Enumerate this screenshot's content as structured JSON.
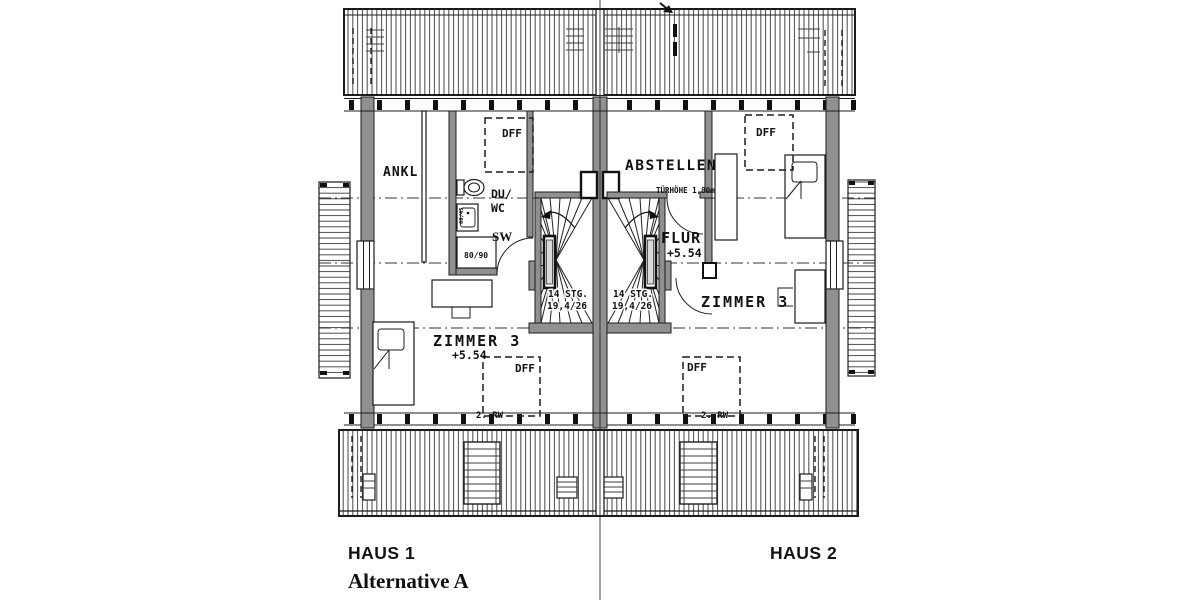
{
  "footer": {
    "haus1": "HAUS 1",
    "alternative": "Alternative A",
    "haus2": "HAUS 2"
  },
  "haus1": {
    "ankl": "ANKL",
    "dff_top": "DFF",
    "du": "DU/",
    "wc": "WC",
    "sw": "SW",
    "shower_size": "80/90",
    "basin_size": "60/45",
    "zimmer": "ZIMMER 3",
    "level": "+5.54",
    "dff_bottom": "DFF",
    "rw": "2. RW",
    "stairs_line1": "14 STG.",
    "stairs_line2": "19,4/26"
  },
  "haus2": {
    "abstellen": "ABSTELLEN",
    "door_height": "TÜRHÖHE 1,80m",
    "flur": "FLUR",
    "level": "+5.54",
    "dff_top": "DFF",
    "zimmer": "ZIMMER 3",
    "dff_bottom": "DFF",
    "rw": "2. RW",
    "stairs_line1": "14 STG.",
    "stairs_line2": "19,4/26"
  },
  "colors": {
    "wall_fill": "#909090",
    "line": "#1c1c1c",
    "hatch": "#4a4a4a",
    "background": "#ffffff"
  }
}
